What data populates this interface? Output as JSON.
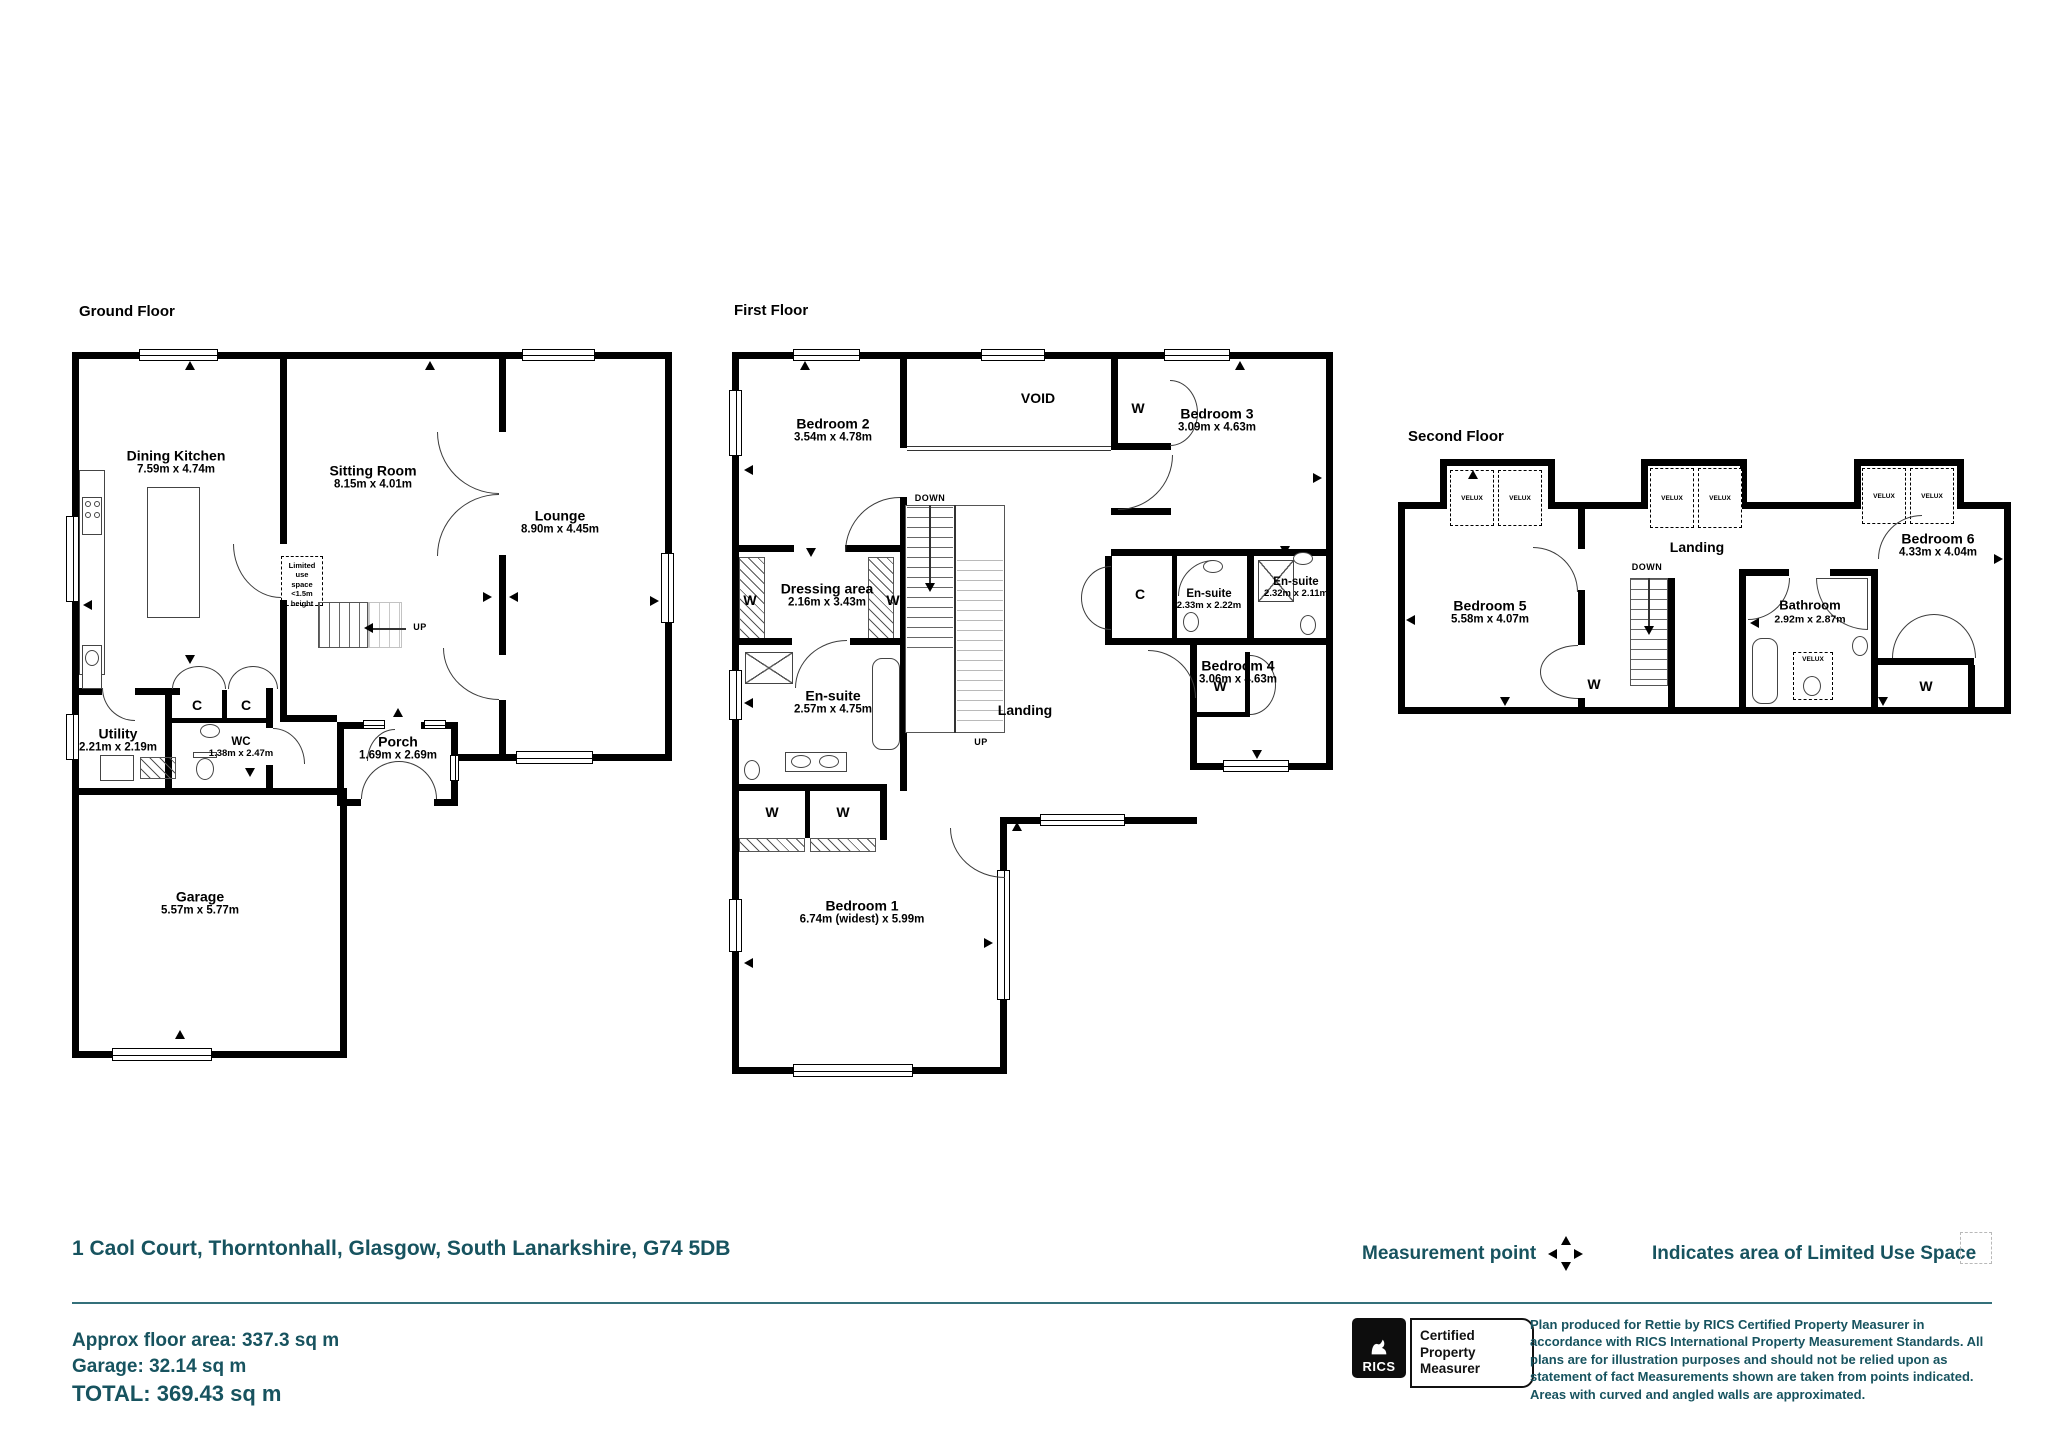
{
  "ground_floor": {
    "title": "Ground Floor",
    "rooms": {
      "dining_kitchen": {
        "name": "Dining Kitchen",
        "dims": "7.59m x 4.74m"
      },
      "sitting_room": {
        "name": "Sitting Room",
        "dims": "8.15m x 4.01m"
      },
      "lounge": {
        "name": "Lounge",
        "dims": "8.90m x 4.45m"
      },
      "utility": {
        "name": "Utility",
        "dims": "2.21m x 2.19m"
      },
      "wc": {
        "name": "WC",
        "dims": "1.38m x 2.47m"
      },
      "porch": {
        "name": "Porch",
        "dims": "1.69m x 2.69m"
      },
      "garage": {
        "name": "Garage",
        "dims": "5.57m x 5.77m"
      }
    },
    "limited_use_note": [
      "Limited use",
      "space",
      "<1.5m height"
    ]
  },
  "first_floor": {
    "title": "First Floor",
    "rooms": {
      "bedroom2": {
        "name": "Bedroom 2",
        "dims": "3.54m x 4.78m"
      },
      "bedroom3": {
        "name": "Bedroom 3",
        "dims": "3.09m x 4.63m"
      },
      "dressing": {
        "name": "Dressing area",
        "dims": "2.16m x 3.43m"
      },
      "ensuite_a": {
        "name": "En-suite",
        "dims": "2.33m x 2.22m"
      },
      "ensuite_b": {
        "name": "En-suite",
        "dims": "2.32m x 2.11m"
      },
      "ensuite_c": {
        "name": "En-suite",
        "dims": "2.57m x 4.75m"
      },
      "bedroom4": {
        "name": "Bedroom 4",
        "dims": "3.06m x 4.63m"
      },
      "landing": {
        "name": "Landing"
      },
      "bedroom1": {
        "name": "Bedroom 1",
        "dims": "6.74m (widest) x 5.99m"
      }
    }
  },
  "second_floor": {
    "title": "Second Floor",
    "rooms": {
      "bedroom5": {
        "name": "Bedroom 5",
        "dims": "5.58m x 4.07m"
      },
      "landing": {
        "name": "Landing"
      },
      "bathroom": {
        "name": "Bathroom",
        "dims": "2.92m x 2.87m"
      },
      "bedroom6": {
        "name": "Bedroom 6",
        "dims": "4.33m x 4.04m"
      }
    }
  },
  "labels": {
    "wardrobe": "W",
    "closet": "C",
    "void": "VOID",
    "up": "UP",
    "down": "DOWN",
    "velux": "VELUX"
  },
  "footer": {
    "address": "1 Caol Court, Thorntonhall, Glasgow, South Lanarkshire, G74 5DB",
    "approx_area": "Approx floor area: 337.3 sq m",
    "garage_area": "Garage: 32.14 sq m",
    "total_area": "TOTAL: 369.43 sq m"
  },
  "legend": {
    "measurement_point": "Measurement point",
    "limited_use": "Indicates area of  Limited Use Space"
  },
  "certification": {
    "rics": "RICS",
    "lines": [
      "Certified",
      "Property",
      "Measurer"
    ],
    "disclaimer": "Plan produced for Rettie by RICS Certified Property Measurer in accordance with RICS International Property  Measurement Standards.  All plans are for illustration purposes and should not be relied upon as statement of fact Measurements shown are taken from points indicated. Areas with curved and angled walls are approximated."
  }
}
